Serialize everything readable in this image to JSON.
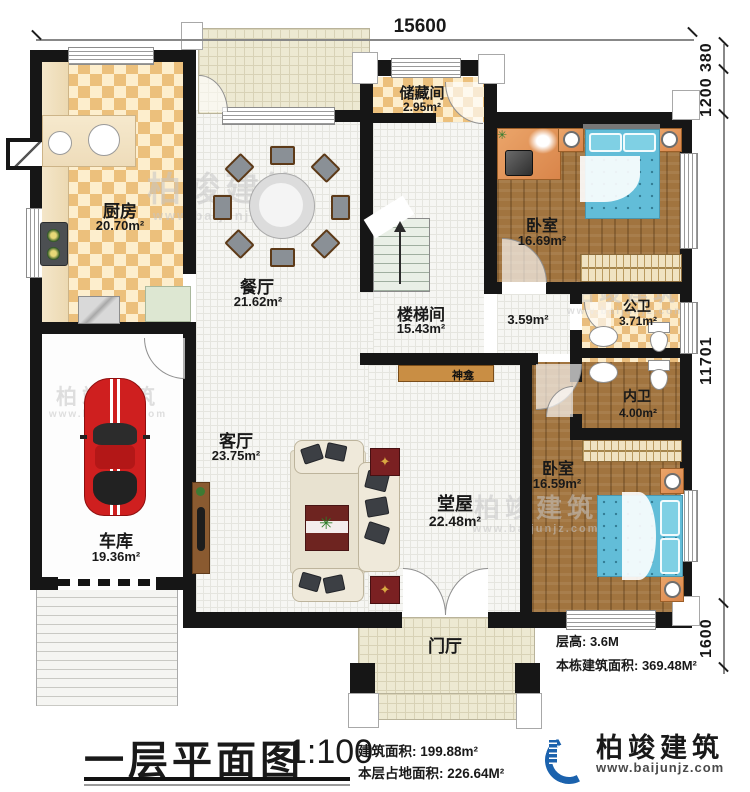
{
  "dimensions": {
    "top": "15600",
    "right_1": "380",
    "right_2": "1200",
    "right_3": "11701",
    "right_4": "1600"
  },
  "rooms": {
    "kitchen": {
      "name": "厨房",
      "area": "20.70m²"
    },
    "storage": {
      "name": "储藏间",
      "area": "2.95m²"
    },
    "bedroom1": {
      "name": "卧室",
      "area": "16.69m²"
    },
    "dining": {
      "name": "餐厅",
      "area": "21.62m²"
    },
    "stairwell": {
      "name": "楼梯间",
      "area": "15.43m²"
    },
    "hallway": {
      "area": "3.59m²"
    },
    "public_bath": {
      "name": "公卫",
      "area": "3.71m²"
    },
    "private_bath": {
      "name": "内卫",
      "area": "4.00m²"
    },
    "living": {
      "name": "客厅",
      "area": "23.75m²"
    },
    "main_hall": {
      "name": "堂屋",
      "area": "22.48m²"
    },
    "bedroom2": {
      "name": "卧室",
      "area": "16.59m²"
    },
    "garage": {
      "name": "车库",
      "area": "19.36m²"
    },
    "foyer": {
      "name": "门厅"
    },
    "shrine": {
      "name": "神龛"
    }
  },
  "notes": {
    "floor_height": "层高: 3.6M",
    "building_total": "本栋建筑面积: 369.48M²"
  },
  "titleblock": {
    "title": "一层平面图",
    "scale": "1:100",
    "line1": "建筑面积: 199.88m²",
    "line2": "本层占地面积: 226.64M²"
  },
  "brand": {
    "name": "柏竣建筑",
    "url": "www.baijunjz.com"
  },
  "colors": {
    "wall": "#161616",
    "tile_orange": "#ecc07c",
    "wood": "#a1743f",
    "bed_blue": "#62bdd8",
    "car_red": "#cf1f1f",
    "logo_blue": "#1b62ad",
    "logo_orange": "#f08519",
    "shrine": "#c98e44"
  }
}
